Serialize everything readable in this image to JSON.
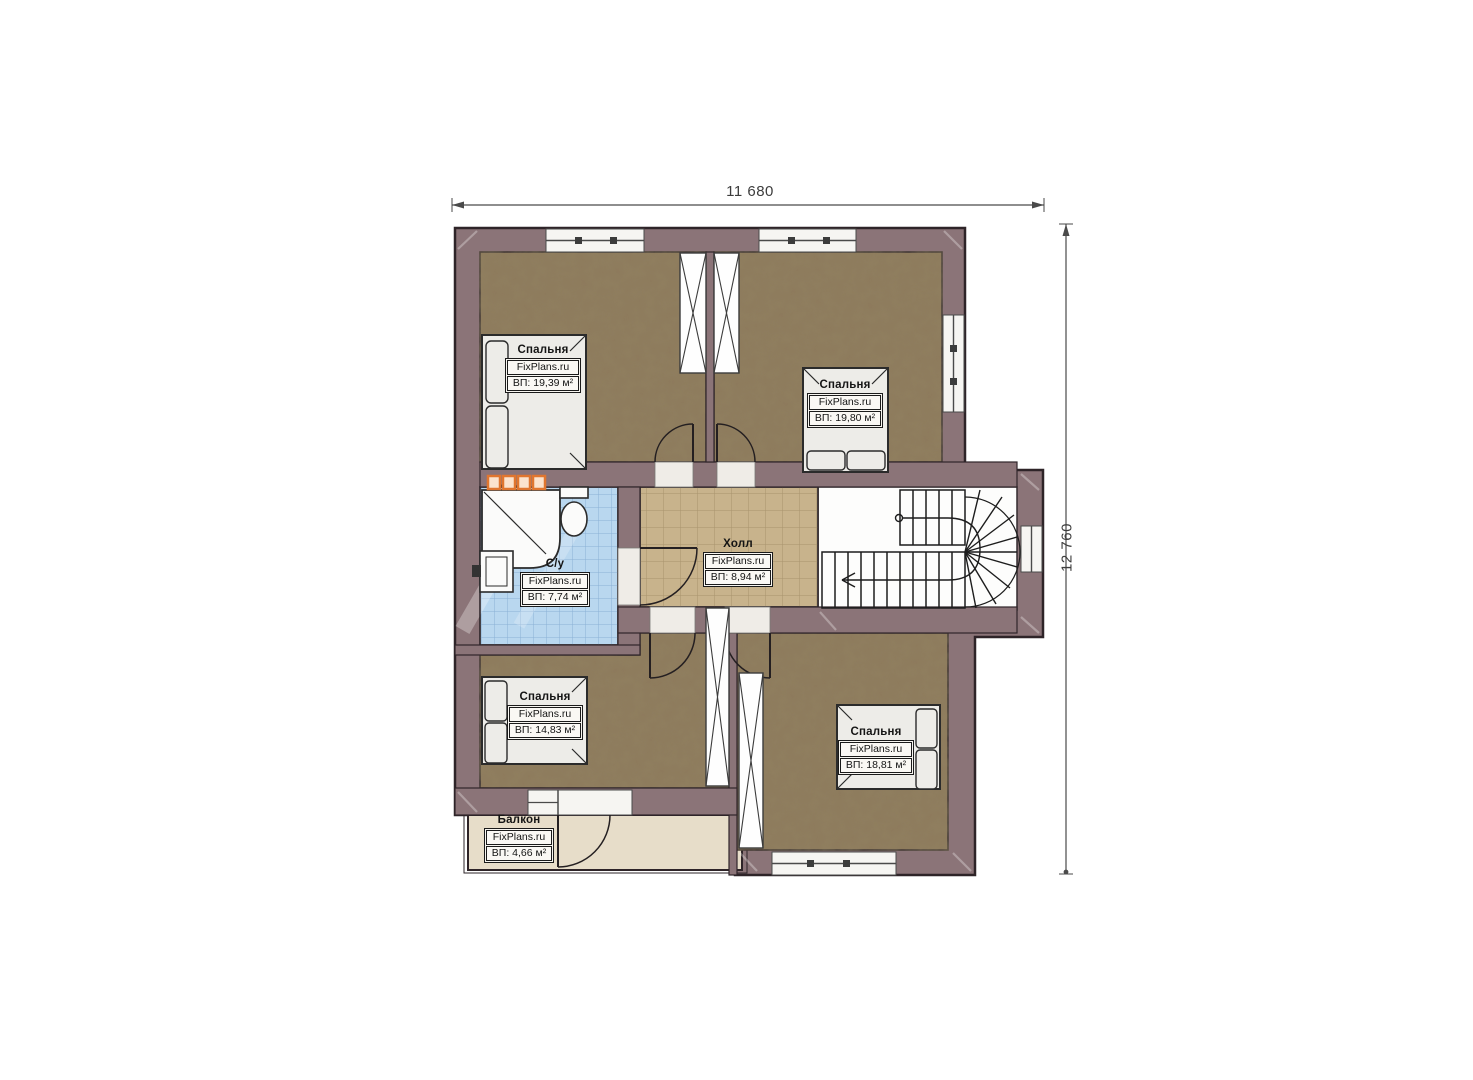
{
  "plan": {
    "brand": "FixPlans.ru",
    "type": "floor-plan",
    "floor_description": "Second floor plan with four bedrooms, bathroom, hall, staircase and balcony"
  },
  "dimensions": {
    "width": "11 680",
    "height": "12 760"
  },
  "rooms": [
    {
      "name": "Спальня",
      "brand": "FixPlans.ru",
      "area": "ВП: 19,39 м²"
    },
    {
      "name": "Спальня",
      "brand": "FixPlans.ru",
      "area": "ВП: 19,80 м²"
    },
    {
      "name": "С/у",
      "brand": "FixPlans.ru",
      "area": "ВП: 7,74 м²"
    },
    {
      "name": "Холл",
      "brand": "FixPlans.ru",
      "area": "ВП: 8,94 м²"
    },
    {
      "name": "Спальня",
      "brand": "FixPlans.ru",
      "area": "ВП: 14,83 м²"
    },
    {
      "name": "Спальня",
      "brand": "FixPlans.ru",
      "area": "ВП: 18,81 м²"
    },
    {
      "name": "Балкон",
      "brand": "FixPlans.ru",
      "area": "ВП: 4,66 м²"
    }
  ],
  "colors": {
    "wall": "#8b7478",
    "wall_outline": "#2e2428",
    "bedroom_floor": "#8d7a5c",
    "bathroom_floor": "#b9d7ef",
    "hall_floor": "#c8b38c",
    "balcony_floor": "#e7ddc9",
    "stair_floor": "#fdfdfc",
    "furniture": "#edece8",
    "accent_orange": "#e0762f",
    "dimension_line": "#4a4a4a"
  }
}
